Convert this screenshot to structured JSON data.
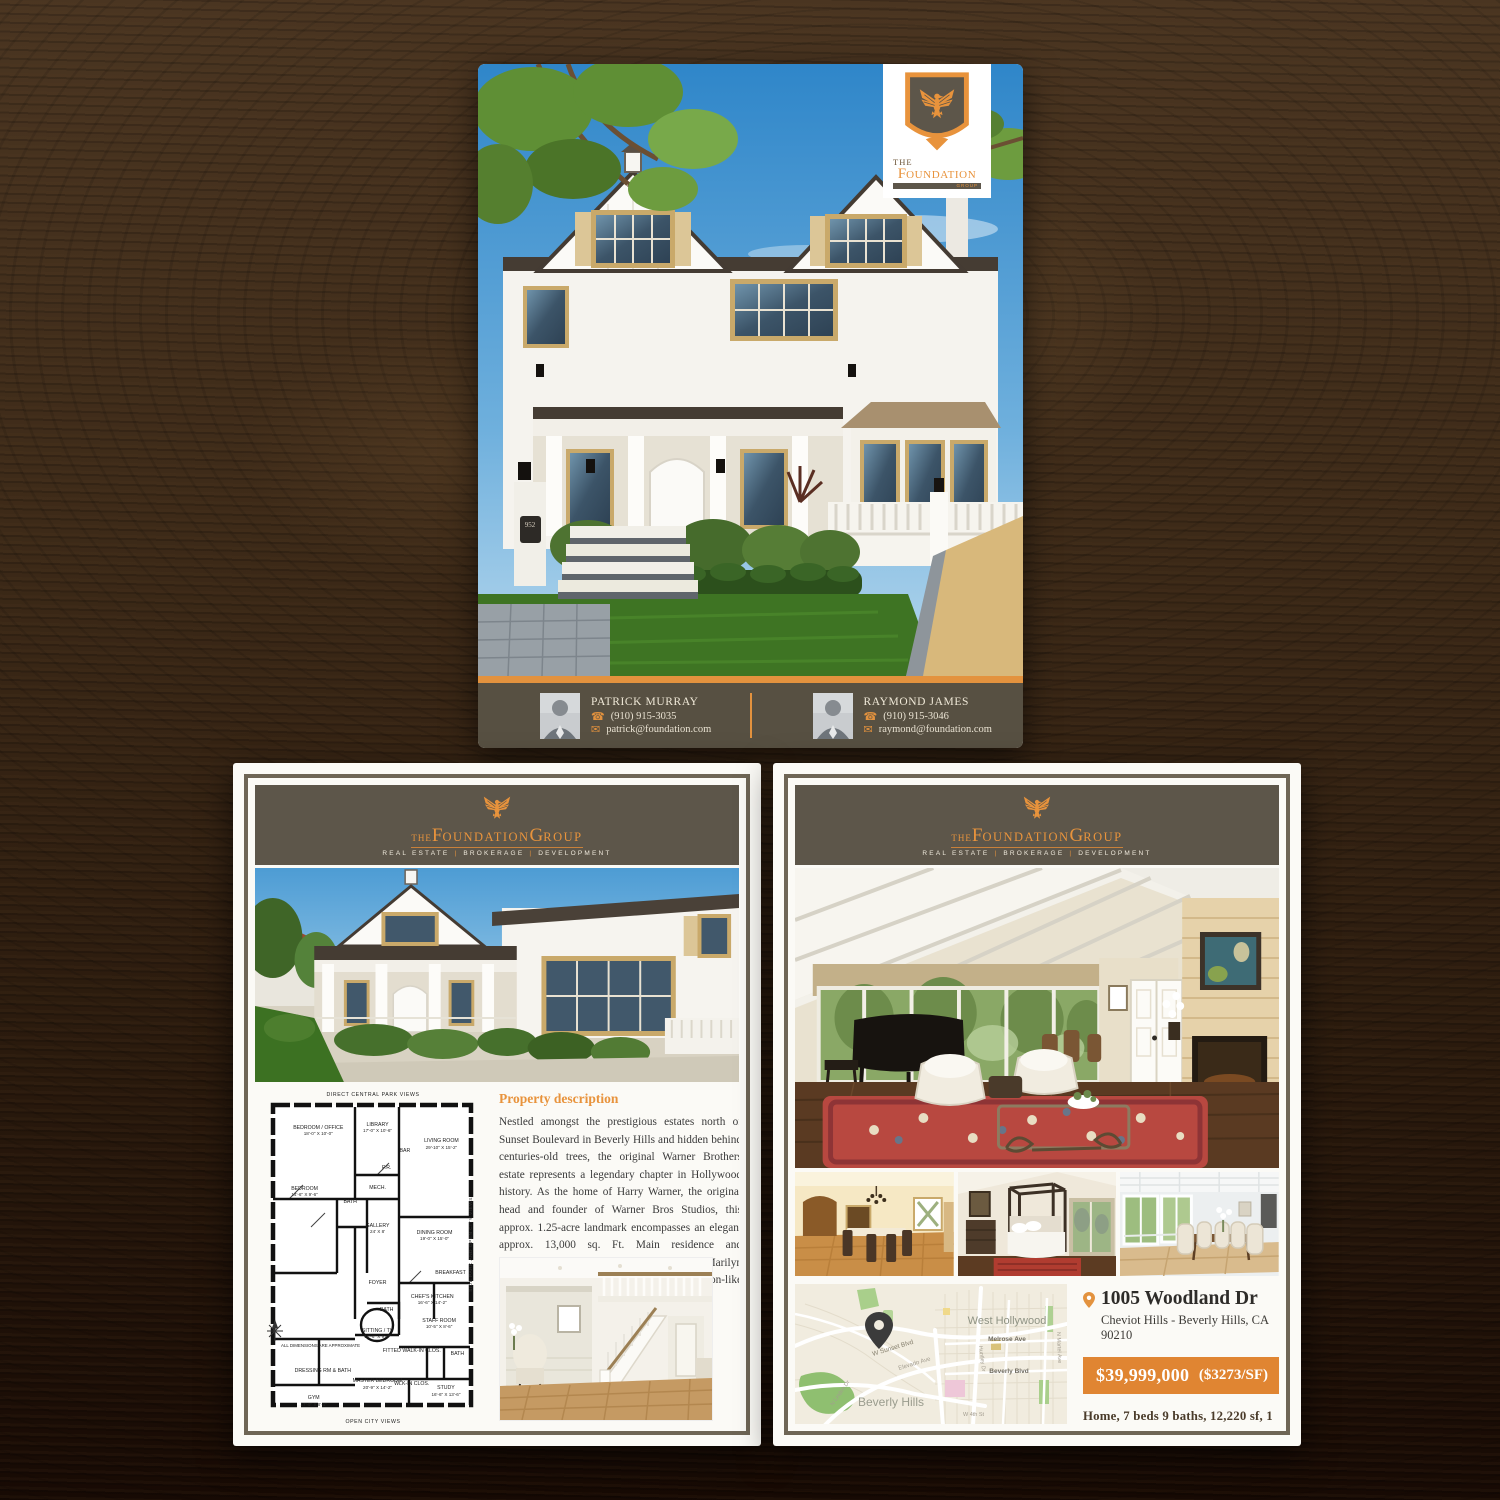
{
  "brand": {
    "the": "THE",
    "foundation_initial": "F",
    "foundation_rest": "OUNDATION",
    "group_initial": "G",
    "group_rest": "ROUP",
    "tagline": [
      "REAL ESTATE",
      "BROKERAGE",
      "DEVELOPMENT"
    ],
    "tagline_sep": "|",
    "colors": {
      "orange": "#E3923E",
      "olive": "#5D564A"
    }
  },
  "top_flyer": {
    "plaque": "952",
    "agents": [
      {
        "name": "PATRICK MURRAY",
        "phone": "(910) 915-3035",
        "email": "patrick@foundation.com"
      },
      {
        "name": "RAYMOND JAMES",
        "phone": "(910) 915-3046",
        "email": "raymond@foundation.com"
      }
    ]
  },
  "plan_flyer": {
    "heading": "Property description",
    "description": "Nestled amongst the prestigious estates north of Sunset Boulevard in Beverly Hills and hidden behind centuries-old trees, the original Warner Brothers estate represents a legendary chapter in Hollywood history. As the home of Harry Warner, the original head and founder of Warner Bros Studios, this approx. 1.25-acre landmark encompasses an elegant approx. 13,000 sq. Ft. Main residence and guesthouse (the once-upon-a-time home of Marilyn Monroe). European garden, rock-lagoon-like pool/spa, waterfalls, and tennis court.",
    "floor_plan": {
      "top_note": "DIRECT CENTRAL PARK VIEWS",
      "bottom_note": "OPEN CITY VIEWS",
      "side_note": "SIDE PARK AND OPEN CITY VIEWS",
      "disclaimer": "ALL DIMENSIONS ARE APPROXIMATE",
      "rooms": [
        {
          "label": "BEDROOM / OFFICE",
          "dims": "18'-0\" X 10'-0\"",
          "x": 26,
          "y": 13
        },
        {
          "label": "LIBRARY",
          "dims": "17'-0\" X 10'-6\"",
          "x": 52,
          "y": 12
        },
        {
          "label": "BAR",
          "dims": "",
          "x": 64,
          "y": 19
        },
        {
          "label": "LIVING ROOM",
          "dims": "29'-10\" X 15'-2\"",
          "x": 80,
          "y": 17
        },
        {
          "label": "P.R.",
          "dims": "",
          "x": 56,
          "y": 24
        },
        {
          "label": "BEDROOM",
          "dims": "14'-6\" X 9'-6\"",
          "x": 20,
          "y": 31
        },
        {
          "label": "BATH",
          "dims": "",
          "x": 40,
          "y": 34
        },
        {
          "label": "MECH.",
          "dims": "",
          "x": 52,
          "y": 30
        },
        {
          "label": "GALLERY",
          "dims": "24' X 8'",
          "x": 52,
          "y": 42
        },
        {
          "label": "DINING ROOM",
          "dims": "19'-0\" X 15'-0\"",
          "x": 77,
          "y": 44
        },
        {
          "label": "FOYER",
          "dims": "",
          "x": 52,
          "y": 58
        },
        {
          "label": "BREAKFAST",
          "dims": "",
          "x": 84,
          "y": 55
        },
        {
          "label": "CHEF'S KITCHEN",
          "dims": "16'-6\" X 14'-2\"",
          "x": 76,
          "y": 63
        },
        {
          "label": "BATH",
          "dims": "",
          "x": 56,
          "y": 66
        },
        {
          "label": "SITTING / TV",
          "dims": "13'-6\" X 9'-4\"",
          "x": 52,
          "y": 73
        },
        {
          "label": "STAFF ROOM",
          "dims": "10'-5\" X 8'-6\"",
          "x": 79,
          "y": 70
        },
        {
          "label": "FITTED WALK-IN CLOS.",
          "dims": "",
          "x": 67,
          "y": 78
        },
        {
          "label": "BATH",
          "dims": "",
          "x": 87,
          "y": 79
        },
        {
          "label": "DRESSING RM & BATH",
          "dims": "",
          "x": 28,
          "y": 84
        },
        {
          "label": "MASTER BEDROOM",
          "dims": "20'-9\" X 14'-2\"",
          "x": 52,
          "y": 88
        },
        {
          "label": "WLK-IN CLOS.",
          "dims": "",
          "x": 67,
          "y": 88
        },
        {
          "label": "STUDY",
          "dims": "16'-6\" X 13'-6\"",
          "x": 82,
          "y": 90
        },
        {
          "label": "GYM",
          "dims": "17'-9\" X 8'-1\"",
          "x": 24,
          "y": 93
        }
      ]
    }
  },
  "listing_flyer": {
    "address": "1005 Woodland Dr",
    "location": "Cheviot Hills - Beverly Hills, CA 90210",
    "price": "$39,999,000",
    "price_per": "($3273/SF)",
    "summary": "Home, 7 beds 9 baths, 12,220 sf, 1 acre lot",
    "map": {
      "areas": [
        "West Hollywood",
        "Beverly Hills"
      ],
      "streets": [
        "W Sunset Blvd",
        "Elevado Ave",
        "Melrose Ave",
        "Beverly Blvd",
        "Huntley Dr",
        "N Martel Ave",
        "N Linden Dr",
        "W 4th St"
      ]
    }
  }
}
